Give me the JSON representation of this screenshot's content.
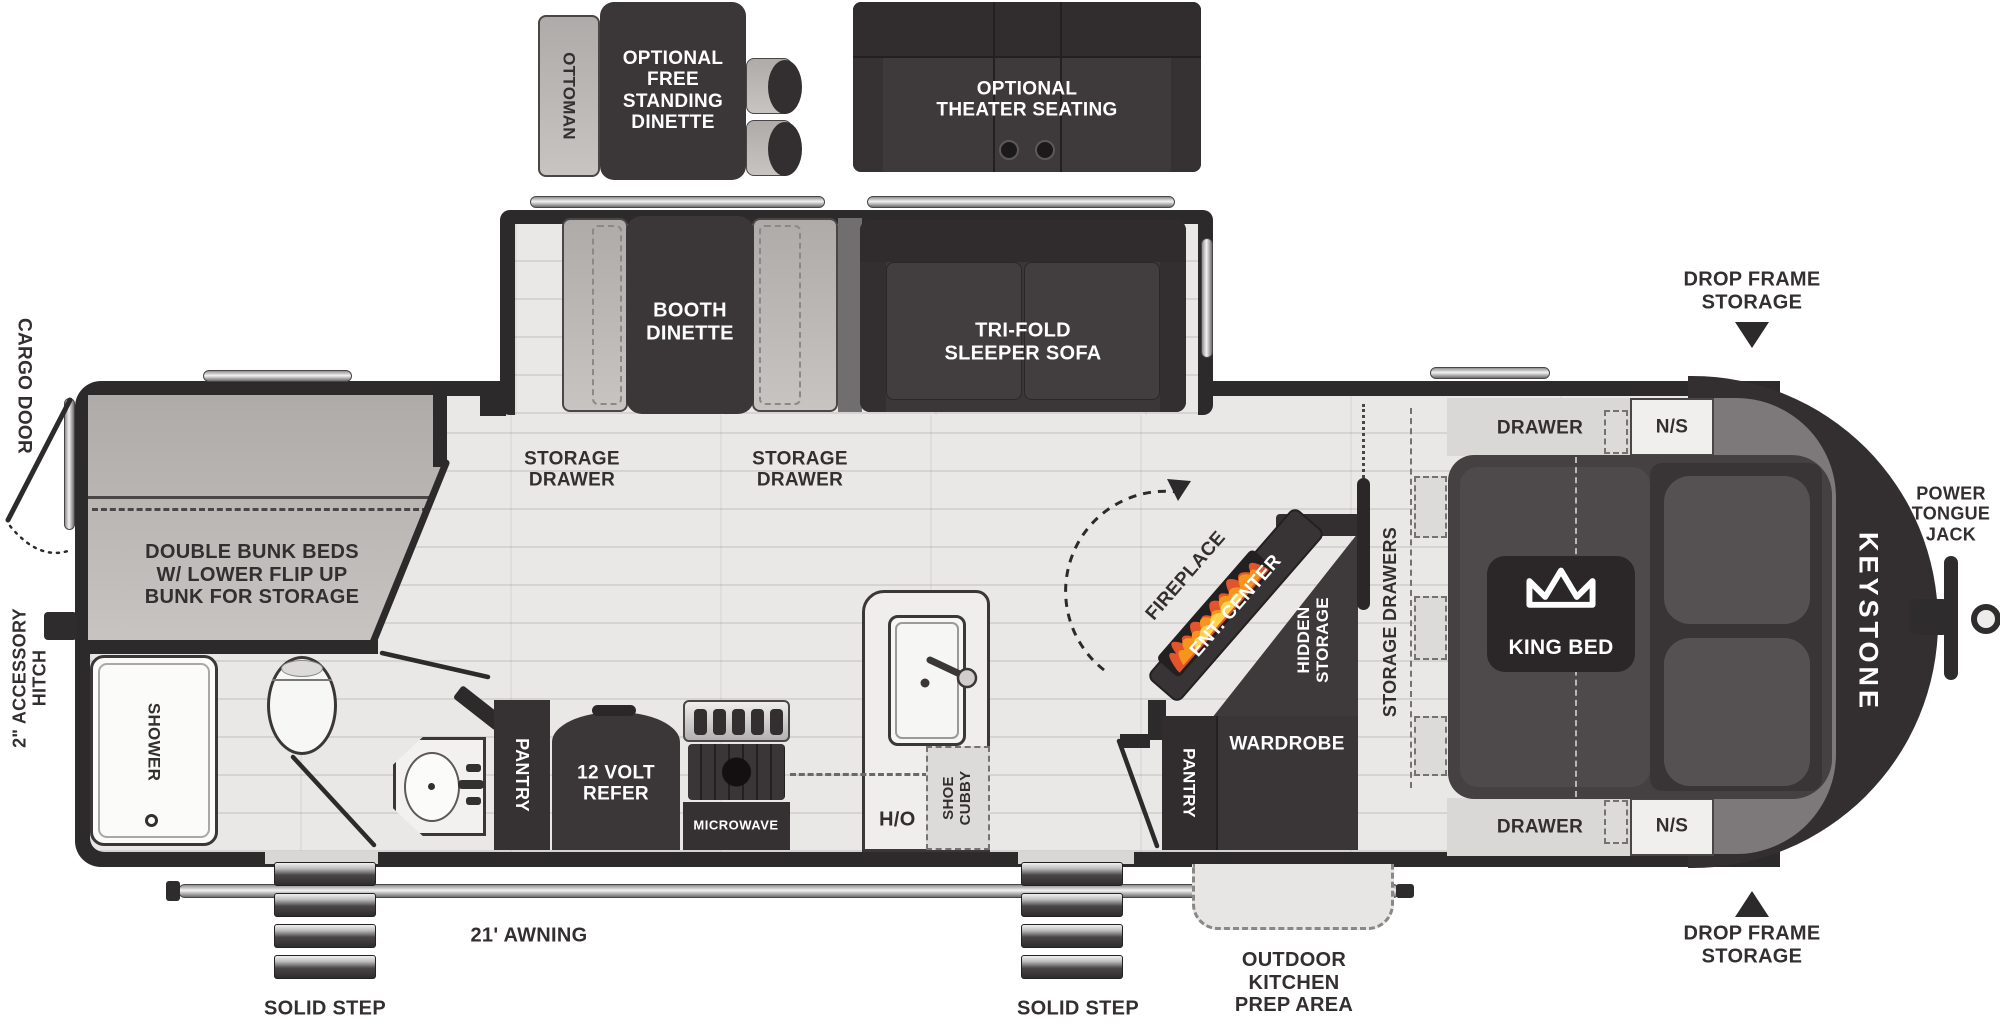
{
  "title": "Keystone travel trailer floor plan",
  "colors": {
    "wall": "#2d2a2b",
    "furniture_dark": "#3b3738",
    "soft_gray": "#b5b2af",
    "floor": "#e8e7e6",
    "counter": "#efeeed",
    "label": "#332f30",
    "flame_orange": "#f28c28",
    "flame_red": "#e2542b",
    "flame_yellow": "#ffd34e"
  },
  "optional_top": {
    "ottoman": "OTTOMAN",
    "free_standing_dinette": "OPTIONAL\nFREE\nSTANDING\nDINETTE",
    "theater_seating": "OPTIONAL\nTHEATER SEATING"
  },
  "slide_out": {
    "booth_dinette": "BOOTH\nDINETTE",
    "sleeper_sofa": "TRI-FOLD\nSLEEPER SOFA",
    "storage_drawer_left": "STORAGE\nDRAWER",
    "storage_drawer_right": "STORAGE\nDRAWER"
  },
  "bunk_room": {
    "bunk_beds": "DOUBLE BUNK BEDS\nW/ LOWER FLIP UP\nBUNK FOR STORAGE"
  },
  "bathroom": {
    "shower": "SHOWER"
  },
  "kitchen": {
    "pantry": "PANTRY",
    "refer": "12 VOLT\nREFER",
    "microwave": "MICROWAVE",
    "overhead": "O/H",
    "shoe_cubby": "SHOE\nCUBBY"
  },
  "living": {
    "fireplace": "FIREPLACE",
    "ent_center": "ENT. CENTER",
    "hidden_storage": "HIDDEN\nSTORAGE"
  },
  "bedroom": {
    "storage_drawers": "STORAGE DRAWERS",
    "wardrobe": "WARDROBE",
    "pantry": "PANTRY",
    "drawer_front": "DRAWER",
    "nightstand_front": "N/S",
    "drawer_rear": "DRAWER",
    "nightstand_rear": "N/S",
    "king_bed": "KING BED"
  },
  "exterior": {
    "cargo_door": "CARGO DOOR",
    "accessory_hitch": "2\" ACCESSORY\nHITCH",
    "awning": "21' AWNING",
    "solid_step_left": "SOLID STEP",
    "solid_step_right": "SOLID STEP",
    "outdoor_kitchen": "OUTDOOR\nKITCHEN\nPREP AREA",
    "drop_frame_storage_front": "DROP FRAME\nSTORAGE",
    "drop_frame_storage_rear": "DROP FRAME\nSTORAGE",
    "power_tongue_jack": "POWER\nTONGUE\nJACK",
    "brand": "KEYSTONE"
  }
}
